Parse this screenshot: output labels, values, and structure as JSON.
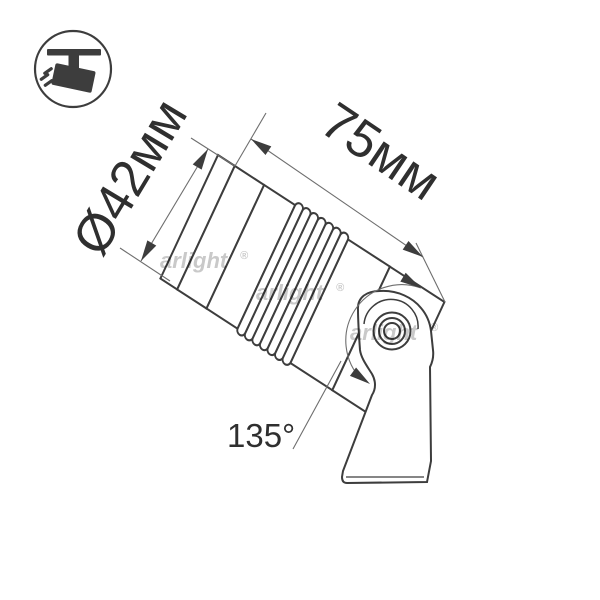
{
  "labels": {
    "diameter": "Ø42мм",
    "length": "75мм",
    "angle": "135°"
  },
  "watermark": {
    "name": "arlight",
    "reg": "®"
  },
  "logo": {
    "icon": "track-spotlight-icon"
  },
  "colors": {
    "line": "#3d3d3d",
    "thin": "#6e6e6e",
    "text": "#2f2f2f",
    "watermark": "#c9c9c9",
    "bg": "#ffffff"
  }
}
